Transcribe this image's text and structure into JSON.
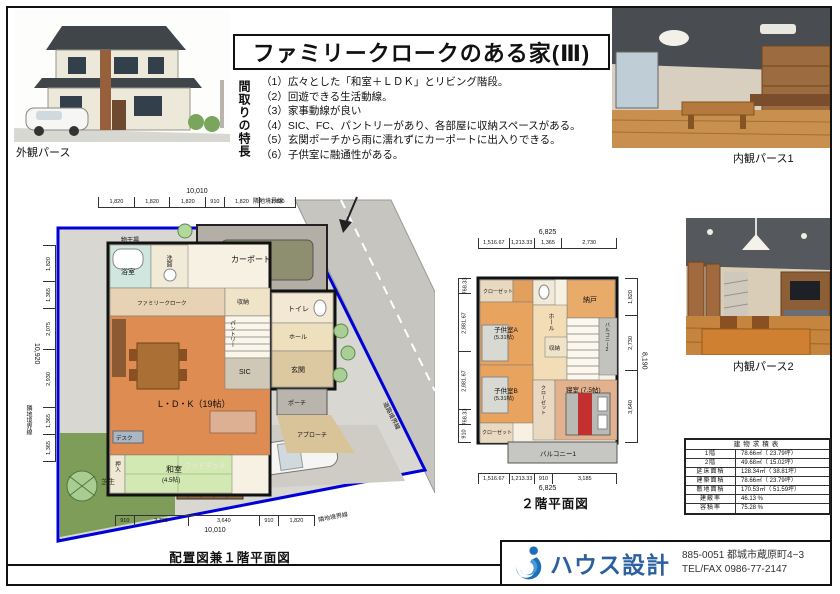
{
  "title": "ファミリークロークのある家(Ⅲ)",
  "features": {
    "heading": "間取りの特長",
    "items": [
      "（1）広々とした「和室＋ＬＤＫ」とリビング階段。",
      "（2）回遊できる生活動線。",
      "（3）家事動線が良い",
      "（4）SIC、FC、パントリーがあり、各部屋に収納スペースがある。",
      "（5）玄関ポーチから雨に濡れずにカーポートに出入りできる。",
      "（6）子供室に融通性がある。"
    ]
  },
  "perspectives": {
    "exterior": "外観パース",
    "interior1": "内観パース1",
    "interior2": "内観パース2"
  },
  "plan1": {
    "caption": "配置図兼１階平面図",
    "dims_top": {
      "total": "10,010",
      "segments": [
        "1,820",
        "1,820",
        "1,820",
        "910",
        "1,820",
        "1,820"
      ]
    },
    "dims_left": {
      "total": "10,920",
      "segments": [
        "1,820",
        "1,365",
        "2,075",
        "2,930",
        "1,365",
        "1,365"
      ]
    },
    "dims_bottom": {
      "total": "10,010",
      "segments": [
        "910",
        "2,730",
        "3,640",
        "910",
        "1,820"
      ]
    },
    "rooms": {
      "monohoshi": "物干場",
      "bath": "浴室",
      "wash": "洗面",
      "cloak": "ファミリークローク",
      "storage": "収納",
      "toilet": "トイレ",
      "hall": "ホール",
      "sic": "SIC",
      "genkan": "玄関",
      "pantry": "パントリー",
      "ldk": "L・D・K（19帖）",
      "washitsu": "和室",
      "washitsu_size": "(4.5帖)",
      "oshiire": "押入",
      "desk": "デスク"
    },
    "site": {
      "carport": "カーポート",
      "deck": "ウッドデッキ",
      "lawn": "芝生",
      "porch": "ポーチ",
      "approach": "アプローチ",
      "boundary_top": "隣地境界線",
      "boundary_left": "隣地境界線",
      "boundary_bottom": "隣地境界線",
      "boundary_road": "道路境界線"
    }
  },
  "plan2": {
    "caption": "２階平面図",
    "dims_top": {
      "total": "6,825",
      "segments": [
        "1,516.67",
        "1,213.33",
        "1,365",
        "2,730"
      ]
    },
    "dims_bottom": {
      "total": "6,825",
      "segments": [
        "1,516.67",
        "1,213.33",
        "910",
        "3,185"
      ]
    },
    "dims_right": {
      "total": "8,190",
      "segments": [
        "1,820",
        "2,730",
        "3,640"
      ]
    },
    "dims_left": {
      "segments": [
        "768.33",
        "2,881.67",
        "2,881.67",
        "768.33",
        "910"
      ]
    },
    "rooms": {
      "closet1": "クローゼット",
      "nando": "納戸",
      "kidsA": "子供室A",
      "kidsA_size": "(5.31帖)",
      "hall": "ホール",
      "storage": "収納",
      "balcony2": "バルコニー2",
      "kidsB": "子供室B",
      "kidsB_size": "(5.31帖)",
      "closet_bl": "クローゼット",
      "closet_v": "クローゼット",
      "bedroom": "寝室 (7.5帖)",
      "balcony1": "バルコニー1"
    }
  },
  "area_table": {
    "title": "建物求積表",
    "rows": [
      {
        "label": "1階",
        "value": "78.66㎡（ 23.79坪）"
      },
      {
        "label": "2階",
        "value": "49.68㎡（ 15.02坪）"
      },
      {
        "label": "延床面積",
        "value": "128.34㎡（ 38.81坪）"
      },
      {
        "label": "建築面積",
        "value": "78.66㎡（ 23.79坪）"
      },
      {
        "label": "敷地面積",
        "value": "170.53㎡（ 51.59坪）"
      },
      {
        "label": "建蔽率",
        "value": "46.13 %"
      },
      {
        "label": "容積率",
        "value": "75.28 %"
      }
    ]
  },
  "company": {
    "name": "ハウス設計",
    "zip_address": "885-0051  都城市蔵原町4−3",
    "tel": "TEL/FAX  0986-77-2147"
  },
  "colors": {
    "boundary_blue": "#0000d8",
    "ldk_orange": "#de8c52",
    "tatami_green": "#d3e9b4",
    "road_gray": "#c6c5bf",
    "logo_blue": "#2b5fa0"
  }
}
